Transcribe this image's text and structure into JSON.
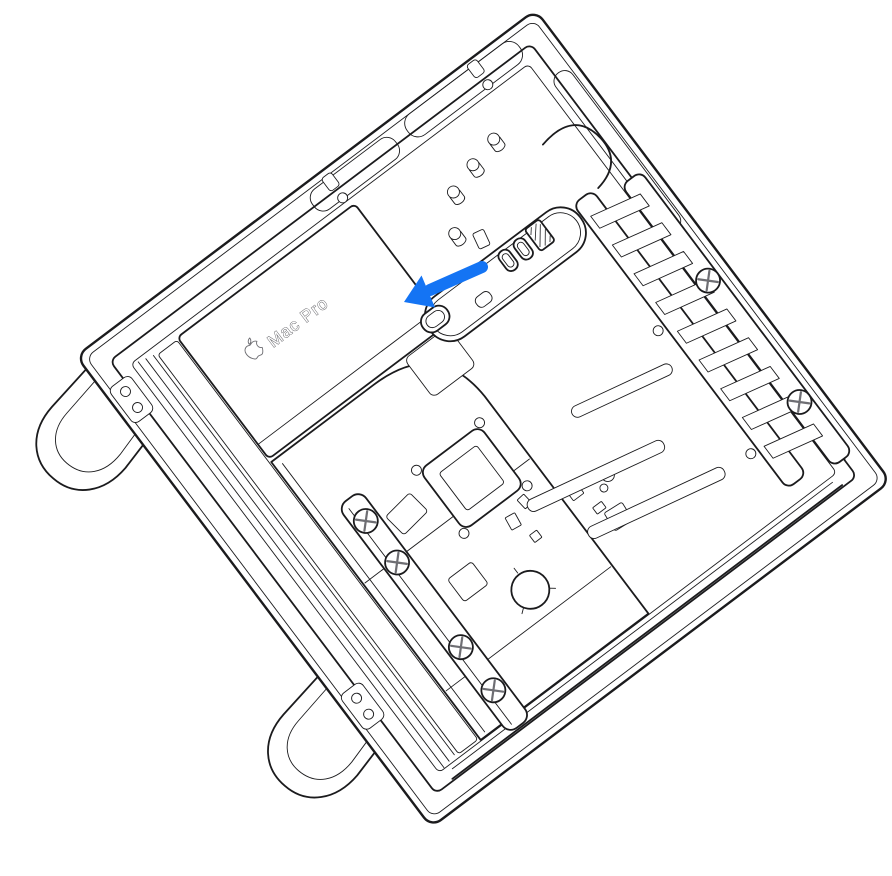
{
  "illustration": {
    "model_label": "Mac Pro",
    "colors": {
      "line": "#1b1b1d",
      "line_soft": "#6e6e73",
      "background": "#ffffff",
      "arrow": "#1474f4"
    },
    "icons": {
      "apple_logo": "apple-logo",
      "callout_arrow": "arrow-down-left"
    }
  }
}
